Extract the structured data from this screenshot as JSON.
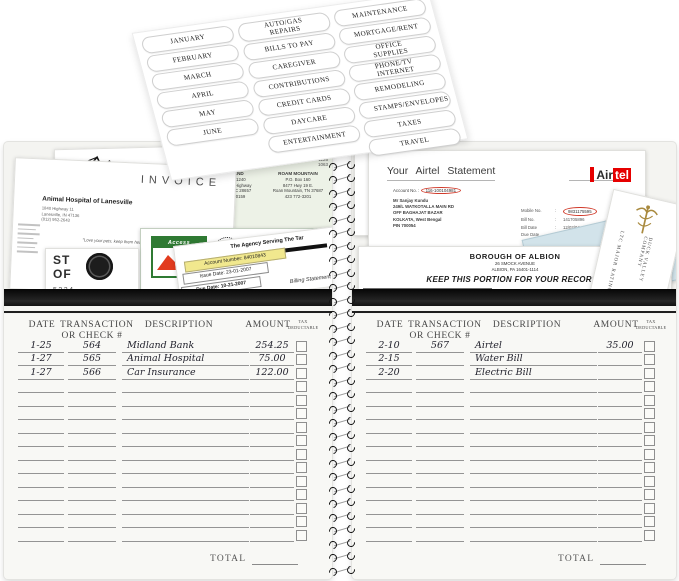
{
  "stickers": {
    "months": [
      "JANUARY",
      "FEBRUARY",
      "MARCH",
      "APRIL",
      "MAY",
      "JUNE"
    ],
    "categories_a": [
      "AUTO/GAS REPAIRS",
      "BILLS TO PAY",
      "CAREGIVER",
      "CONTRIBUTIONS",
      "CREDIT CARDS",
      "DAYCARE",
      "ENTERTAINMENT"
    ],
    "categories_b": [
      "MAINTENANCE",
      "MORTGAGE/RENT",
      "OFFICE SUPPLIES",
      "PHONE/TV INTERNET",
      "REMODELING",
      "STAMPS/ENVELOPES",
      "TAXES",
      "TRAVEL"
    ]
  },
  "left_pocket": {
    "invoice": {
      "title": "INVOICE",
      "company": "Animal Hospital of Lanesville",
      "addr1": "1840 Highway 11",
      "addr2": "Lanesville, IN 47136",
      "addr3": "(812) 952-2643",
      "tagline": "\"Love your pets, keep them healthy\""
    },
    "green_bill": {
      "corner1": "1126",
      "corner2": "1063",
      "left_name": "NEWLAND",
      "left_addr1": "P.O. Box 1240",
      "left_addr2": "73 Db Park Highway",
      "left_addr3": "Newland, NC 28657",
      "left_addr4": "828 733-0159",
      "right_name": "ROAM MOUNTAIN",
      "right_addr1": "P.O. Box 160",
      "right_addr2": "8477 Hwy 19 E.",
      "right_addr3": "Roan Mountain, TN 37687",
      "right_addr4": "423 772-3201",
      "location_label": "LOCATION",
      "location_value": "DRAFT RD 1702",
      "meter_label": "METER NUMBER",
      "meter_value": "1260699"
    },
    "midland": {
      "logo": "Access",
      "bank": "Midland Bank plc",
      "dept1": "Access Department,",
      "dept2": "Access House,"
    },
    "statement": {
      "big1": "ST",
      "big2": "OF",
      "number": "5224"
    },
    "agency": {
      "heading": "The Agency Serving The Tar",
      "account": "Account Number: 84010843",
      "issue": "Issue Date: 23-01-2007",
      "due": "Due Date: 10-21-2007",
      "footer": "Billing Statement"
    }
  },
  "right_pocket": {
    "airtel": {
      "title": "Your Airtel Statement",
      "account_label": "Account No. :",
      "account_value": "116-100104981",
      "name": "Mr Sanjay Kundu",
      "addr1": "249/L WATKOTALLA MAIN RD",
      "addr2": "OFF BAGHAJAT BAZAR",
      "addr3": "KOLKATA, West Bengal",
      "addr4": "PIN 700054",
      "logo_air": "Air",
      "logo_tel": "tel",
      "fields": [
        {
          "label": "Mobile No.",
          "value": "9831175595"
        },
        {
          "label": "Bill No.",
          "value": "141705896"
        },
        {
          "label": "Bill Date",
          "value": "12/02/04"
        },
        {
          "label": "Due Date",
          "value": "27/02/04"
        }
      ],
      "col1": "Previous Balance",
      "col2": "Payments",
      "col3": "Amount Due (Rs.)",
      "amount": "5.41"
    },
    "albion": {
      "name": "BOROUGH OF ALBION",
      "addr1": "26 SMOCK AVENUE",
      "addr2": "ALBION, PA 16401-1114",
      "keep": "KEEP THIS PORTION FOR YOUR RECORDS",
      "headers": [
        "ACCOUNT",
        "BILLING PERIOD",
        "BILL DATE",
        "DUE DATE",
        "SERVICE LOCATION"
      ],
      "row": [
        "10-0",
        "03/23/12 TO 06/21/12",
        "06/25/12",
        "07/16/12",
        "26 SMOCK AVENUE"
      ]
    },
    "card": {
      "text1": "DUCK VALLEY COMPANY",
      "text2": "LTC MAJOR RATING"
    }
  },
  "ledger": {
    "headers": {
      "date": "DATE",
      "trans1": "TRANSACTION",
      "trans2": "OR CHECK #",
      "description": "DESCRIPTION",
      "amount": "AMOUNT",
      "tax1": "TAX",
      "tax2": "DEDUCTABLE"
    },
    "total_label": "TOTAL",
    "left_rows": [
      {
        "date": "1-25",
        "check": "564",
        "desc": "Midland Bank",
        "amount": "254.25"
      },
      {
        "date": "1-27",
        "check": "565",
        "desc": "Animal Hospital",
        "amount": "75.00"
      },
      {
        "date": "1-27",
        "check": "566",
        "desc": "Car Insurance",
        "amount": "122.00"
      },
      {},
      {},
      {},
      {},
      {},
      {},
      {},
      {},
      {},
      {},
      {},
      {}
    ],
    "right_rows": [
      {
        "date": "2-10",
        "check": "567",
        "desc": "Airtel",
        "amount": "35.00"
      },
      {
        "date": "2-15",
        "check": "",
        "desc": "Water Bill",
        "amount": ""
      },
      {
        "date": "2-20",
        "check": "",
        "desc": "Electric Bill",
        "amount": ""
      },
      {},
      {},
      {},
      {},
      {},
      {},
      {},
      {},
      {},
      {},
      {},
      {}
    ]
  }
}
